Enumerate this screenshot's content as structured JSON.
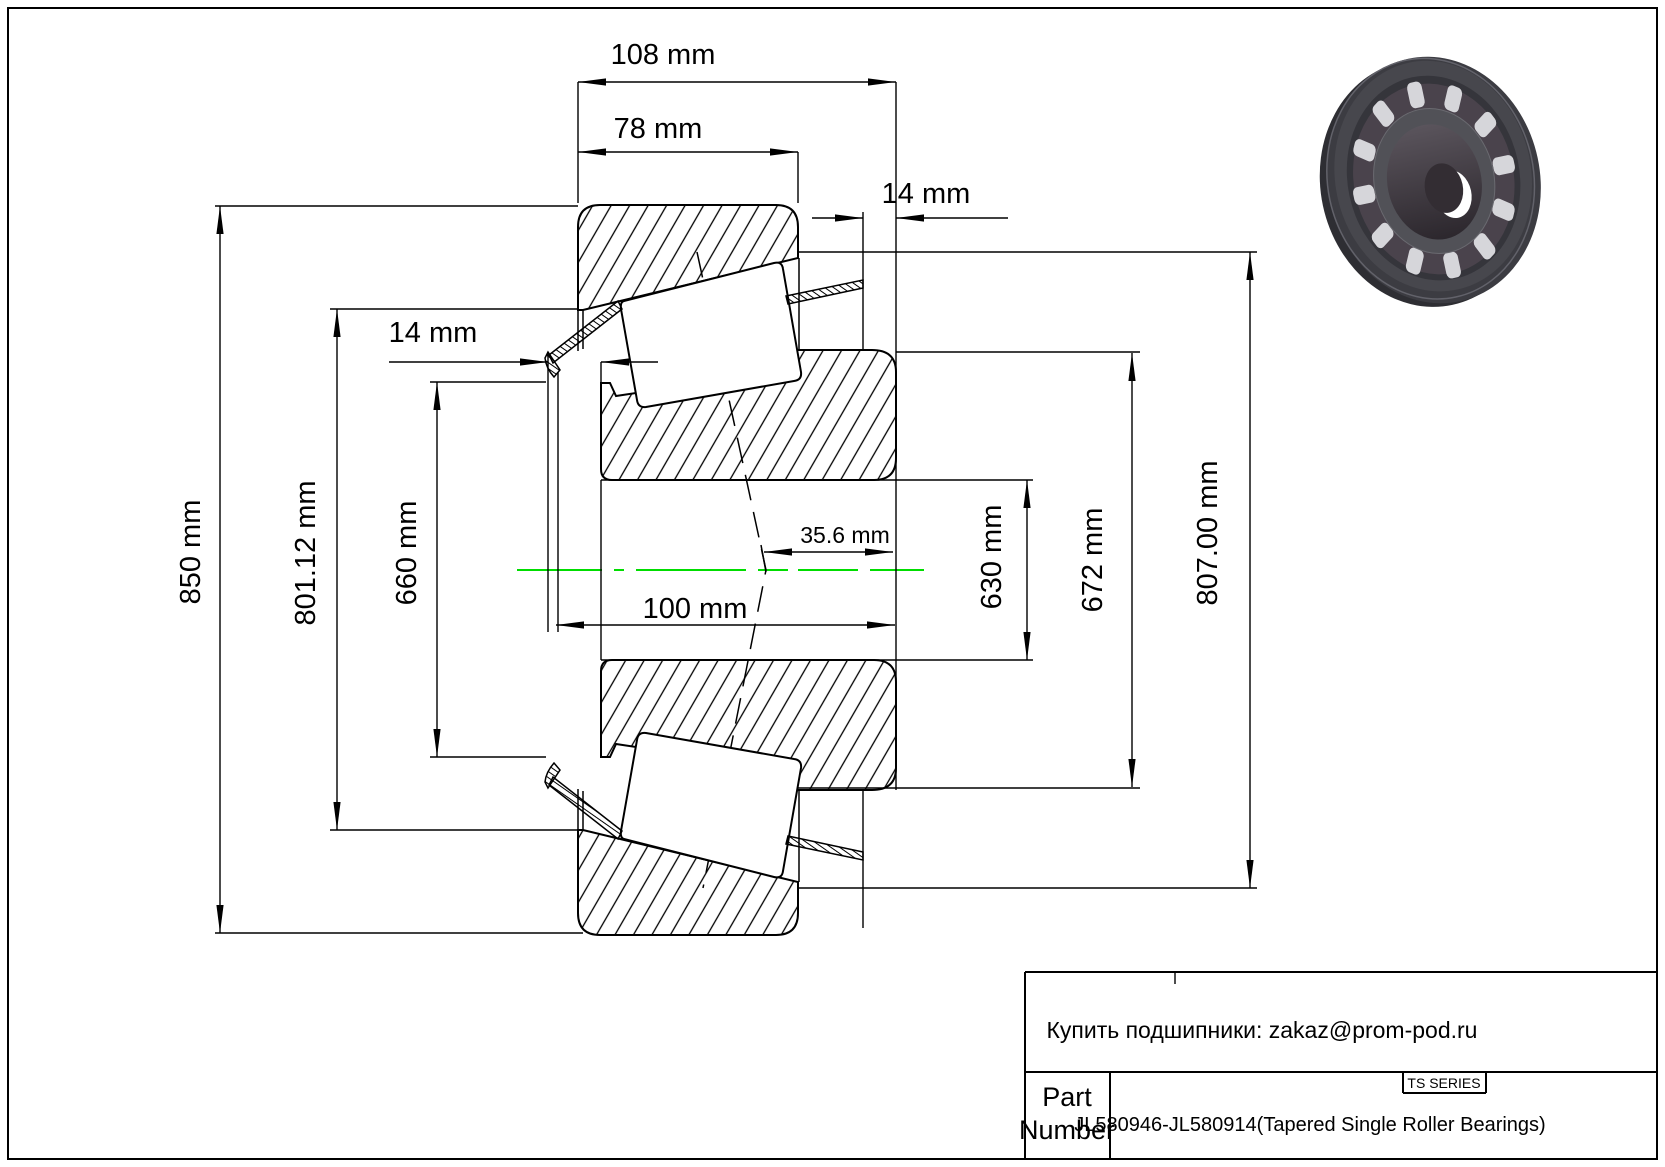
{
  "colors": {
    "centerline": "#00dd00",
    "line": "#000000",
    "render_dark": "#3c3c42",
    "render_roller": "#d6d6da"
  },
  "dims": {
    "total_width": "108 mm",
    "cup_width": "78 mm",
    "cage_protrusion_right": "14 mm",
    "cage_protrusion_left": "14 mm",
    "outer_diameter": "850 mm",
    "cup_raceway_diameter": "801.12 mm",
    "cone_front_rib_diameter": "660 mm",
    "cone_width": "100 mm",
    "effective_center": "35.6 mm",
    "bore_diameter": "630 mm",
    "cone_back_rib_diameter": "672 mm",
    "cup_small_od": "807.00 mm"
  },
  "title_block": {
    "contact_line": "Купить подшипники: zakaz@prom-pod.ru",
    "series_badge": "TS SERIES",
    "part_label_line1": "Part",
    "part_label_line2": "Number",
    "part_number": "JL580946-JL580914",
    "part_descriptor": "(Tapered Single Roller Bearings)"
  }
}
